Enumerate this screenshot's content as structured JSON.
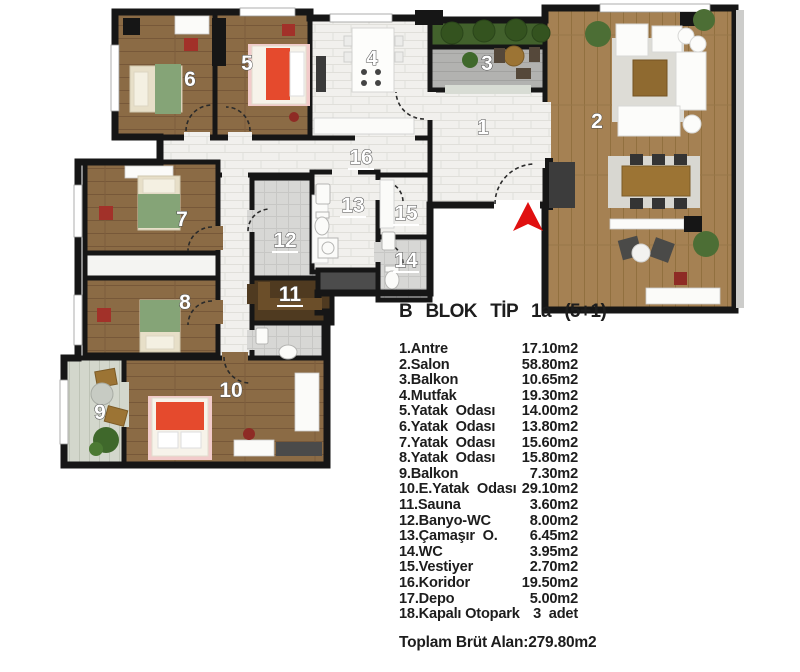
{
  "title": "B  BLOK  TİP  1a  (5+1)",
  "legend": {
    "rows": [
      {
        "name": "1.Antre",
        "area": "17.10m2"
      },
      {
        "name": "2.Salon",
        "area": "58.80m2"
      },
      {
        "name": "3.Balkon",
        "area": "10.65m2"
      },
      {
        "name": "4.Mutfak",
        "area": "19.30m2"
      },
      {
        "name": "5.Yatak  Odası",
        "area": "14.00m2"
      },
      {
        "name": "6.Yatak  Odası",
        "area": "13.80m2"
      },
      {
        "name": "7.Yatak  Odası",
        "area": "15.60m2"
      },
      {
        "name": "8.Yatak  Odası",
        "area": "15.80m2"
      },
      {
        "name": "9.Balkon",
        "area": "7.30m2"
      },
      {
        "name": "10.E.Yatak  Odası",
        "area": "29.10m2"
      },
      {
        "name": "11.Sauna",
        "area": "3.60m2"
      },
      {
        "name": "12.Banyo-WC",
        "area": "8.00m2"
      },
      {
        "name": "13.Çamaşır  O.",
        "area": "6.45m2"
      },
      {
        "name": "14.WC",
        "area": "3.95m2"
      },
      {
        "name": "15.Vestiyer",
        "area": "2.70m2"
      },
      {
        "name": "16.Koridor",
        "area": "19.50m2"
      },
      {
        "name": "17.Depo",
        "area": "5.00m2"
      },
      {
        "name": "18.Kapalı Otopark",
        "area": "3  adet"
      }
    ],
    "total_label": "Toplam Brüt Alan:",
    "total_value": "279.80m2"
  },
  "plan": {
    "room_numbers": [
      "1",
      "2",
      "3",
      "4",
      "5",
      "6",
      "7",
      "8",
      "9",
      "10",
      "11",
      "12",
      "13",
      "14",
      "15",
      "16"
    ],
    "entrance_arrow_color": "#e01010"
  },
  "colors": {
    "wall": "#161616",
    "wood_bedroom": "#8b6b45",
    "wood_salon": "#a58153",
    "tile_white": "#f1f0ed",
    "tile_bath": "#d7d7d5",
    "sauna_wood": "#4f3a20",
    "hedge_green": "#42612c",
    "bed_green": "#85a477",
    "bed_red": "#e54a2d",
    "accent_red": "#a23129"
  }
}
